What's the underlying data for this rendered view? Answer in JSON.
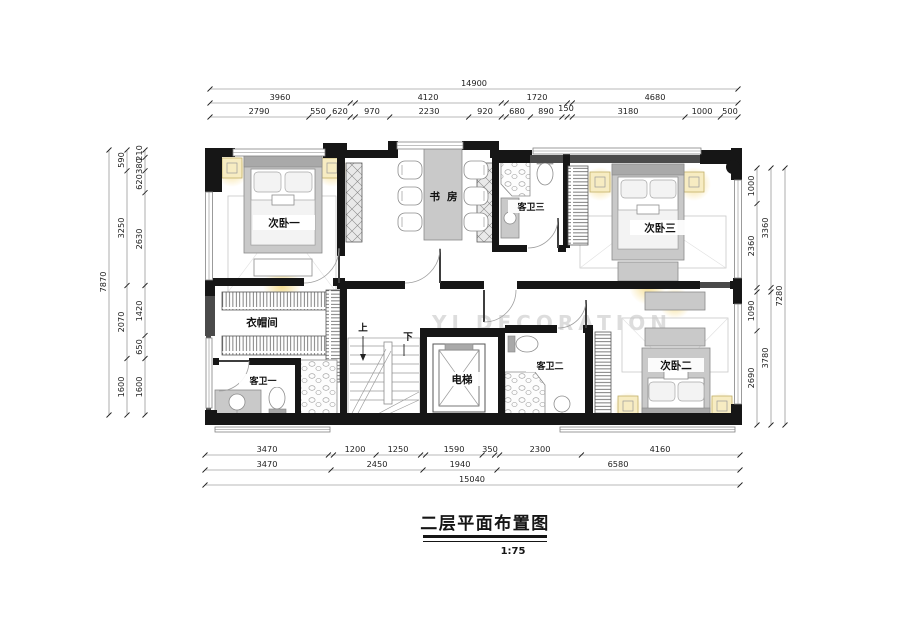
{
  "title": {
    "text": "二层平面布置图",
    "scale": "1:75"
  },
  "watermark": "YI DECORATION",
  "rooms": {
    "bedroom1": "次卧一",
    "study": "书房",
    "bath3": "客卫三",
    "bedroom3": "次卧三",
    "cloakroom": "衣帽间",
    "bath1": "客卫一",
    "elevator": "电梯",
    "bath2": "客卫二",
    "bedroom2": "次卧二"
  },
  "stairs": {
    "up": "上",
    "down": "下"
  },
  "dims": {
    "top": {
      "total": "14900",
      "row2": [
        "3960",
        "4120",
        "1720",
        "4680"
      ],
      "row3": [
        "2790",
        "550",
        "620",
        "970",
        "2230",
        "920",
        "680",
        "890",
        "150",
        "3180",
        "1000",
        "500"
      ]
    },
    "left": {
      "total": "7870",
      "mid": [
        "590",
        "3250",
        "2070",
        "1600"
      ],
      "inner": [
        "210",
        "380",
        "620",
        "2630",
        "1420",
        "650",
        "1600"
      ]
    },
    "right": {
      "total": "7280",
      "mid": [
        "3360",
        "3780"
      ],
      "inner": [
        "1000",
        "2360",
        "1090",
        "2690"
      ]
    },
    "bottom": {
      "total": "15040",
      "row1": [
        "3470",
        "1200",
        "1250",
        "1590",
        "350",
        "2300",
        "4160"
      ],
      "row2": [
        "3470",
        "2450",
        "1940",
        "6580"
      ]
    }
  }
}
